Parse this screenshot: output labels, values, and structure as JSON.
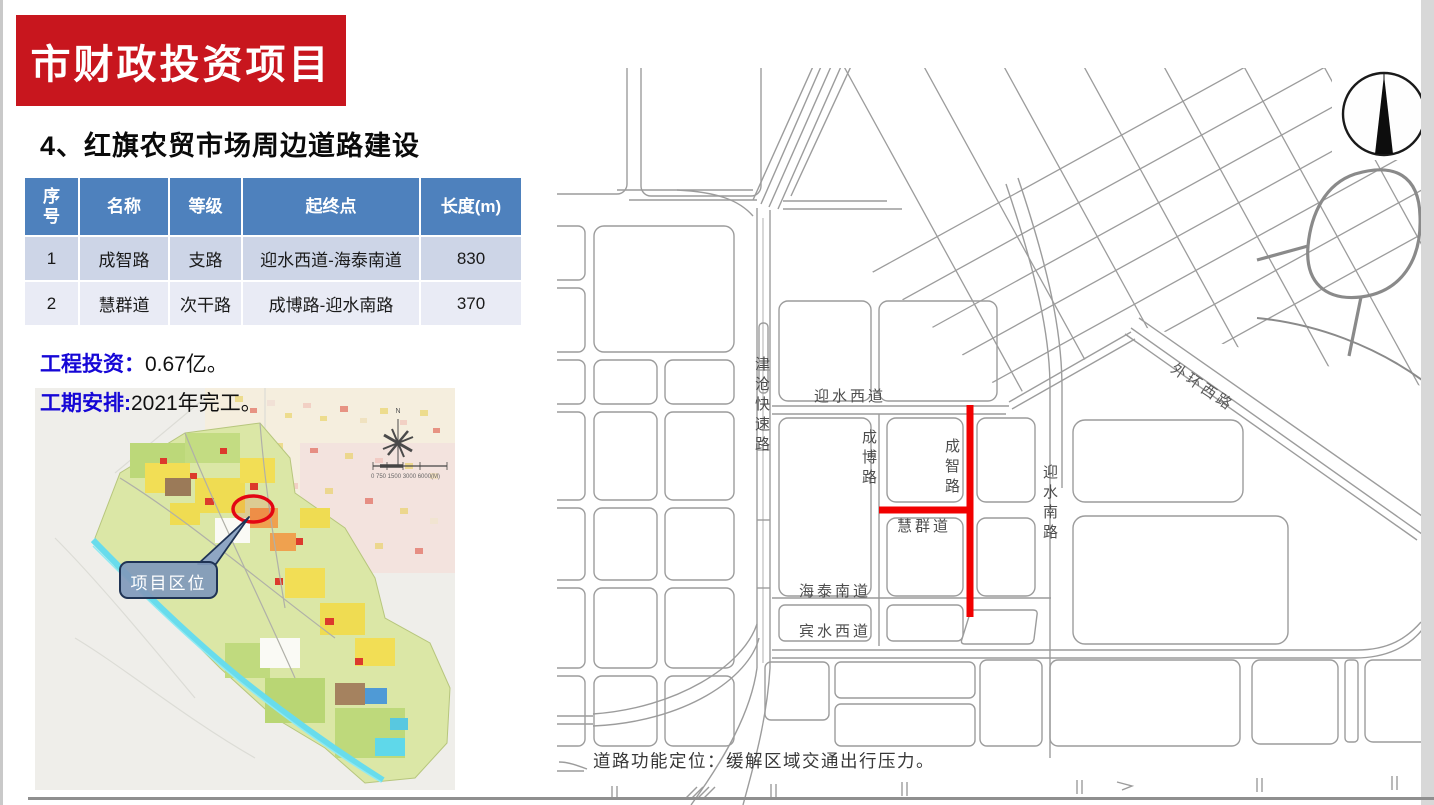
{
  "header": {
    "banner": "市财政投资项目",
    "banner_bg": "#c8161e",
    "title": "4、红旗农贸市场周边道路建设"
  },
  "table": {
    "header_bg": "#4e81bd",
    "row_colors": [
      "#cdd5e7",
      "#e9ebf5"
    ],
    "columns": [
      "序号",
      "名称",
      "等级",
      "起终点",
      "长度(m)"
    ],
    "rows": [
      {
        "no": "1",
        "name": "成智路",
        "grade": "支路",
        "endpoints": "迎水西道-海泰南道",
        "length": "830"
      },
      {
        "no": "2",
        "name": "慧群道",
        "grade": "次干路",
        "endpoints": "成博路-迎水南路",
        "length": "370"
      }
    ]
  },
  "facts": {
    "investment_label": "工程投资：",
    "investment_value": "0.67亿。",
    "schedule_label": "工期安排:",
    "schedule_value": "2021年完工。"
  },
  "location_map": {
    "callout": "项目区位",
    "compass_n": "N",
    "scale_text": "0 750 1500  3000        6000(M)"
  },
  "road_map": {
    "highlight_color": "#f10000",
    "labels": {
      "jincang": "津沧快速路",
      "yingshui_west": "迎水西道",
      "chengbo": "成博路",
      "chengzhi": "成智路",
      "yingshui_south": "迎水南路",
      "waihuan": "外环西路",
      "huiqun": "慧群道",
      "haitai": "海泰南道",
      "binshui": "宾水西道"
    },
    "note": "道路功能定位：缓解区域交通出行压力。"
  }
}
